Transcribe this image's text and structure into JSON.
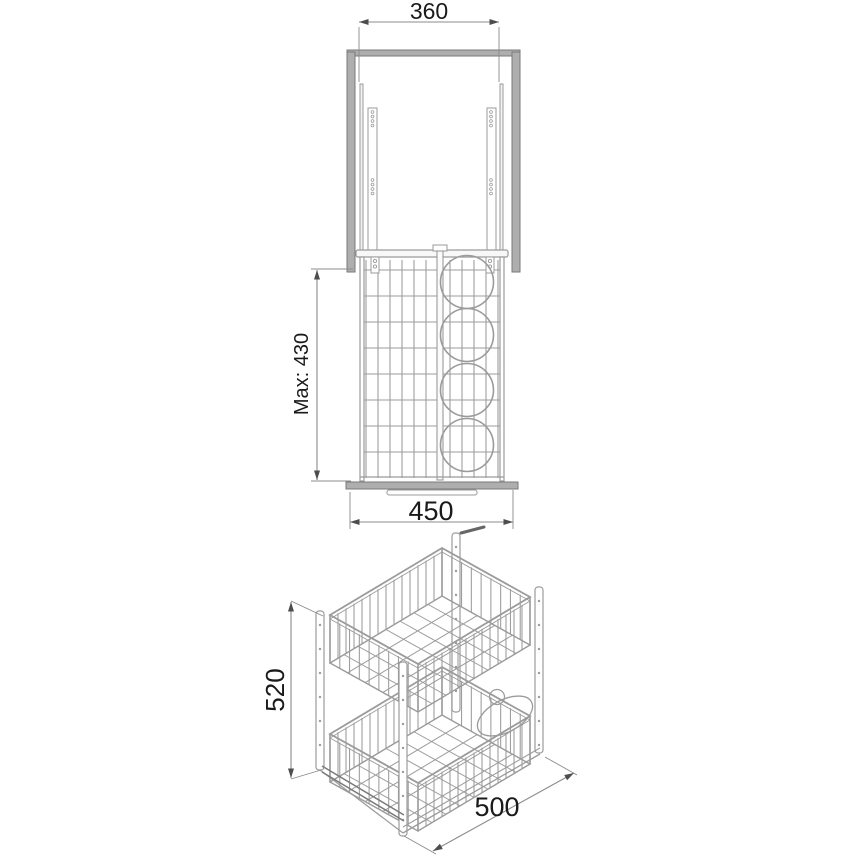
{
  "diagram": {
    "type": "technical drawing",
    "subject": "Two-tier pull-out wire storage basket with bottle rings - dimensioned front view and isometric view",
    "front_view": {
      "dimensions": {
        "top_width": {
          "label": "360"
        },
        "max_height": {
          "label": "Max: 430"
        },
        "base_width": {
          "label": "450"
        }
      }
    },
    "isometric_view": {
      "dimensions": {
        "height": {
          "label": "520"
        },
        "depth": {
          "label": "500"
        }
      }
    },
    "colors": {
      "line": "#9b9b9b",
      "line_dark": "#7a7a7a",
      "fill_gray": "#aeaeae",
      "dimension": "#8b8b8b",
      "arrow": "#4d4d4d",
      "text": "#1a1a1a",
      "background": "#ffffff"
    }
  }
}
